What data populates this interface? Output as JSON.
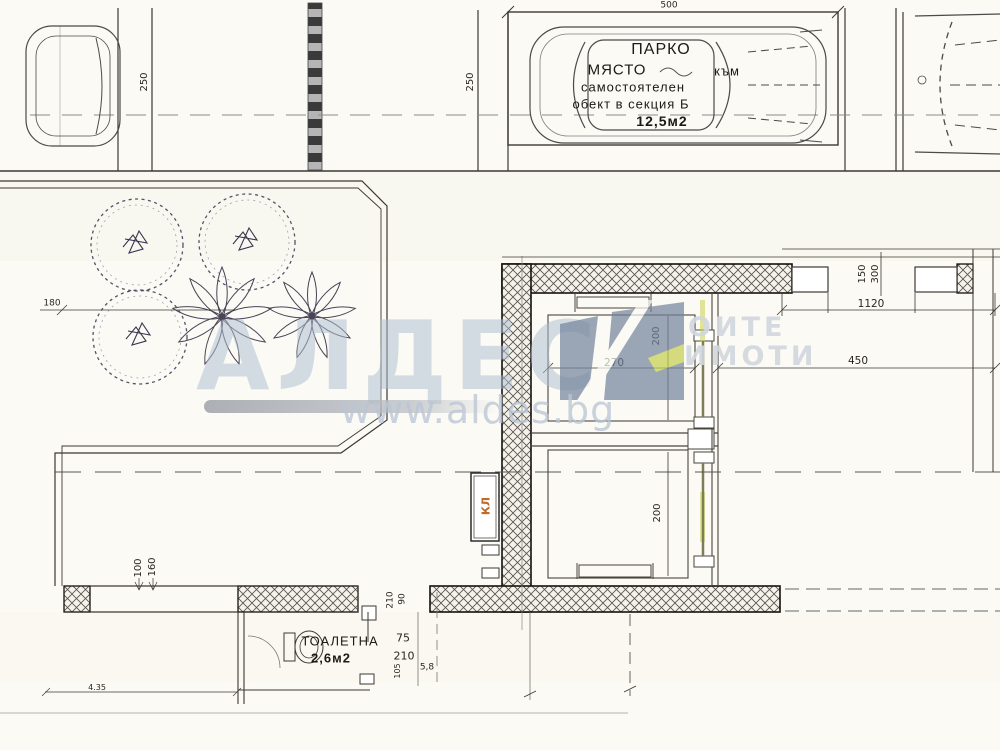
{
  "drawing": {
    "parking_label": {
      "l1": "ПАРКО",
      "l2": "МЯСТО",
      "l2b": "към",
      "l3": "самостоятелен",
      "l4": "обект в секция Б",
      "l5": "12,5м2"
    },
    "toilet_label": {
      "name": "ТОАЛЕТНА",
      "area": "2,6м2"
    },
    "panel_label": "КЛ",
    "dims": {
      "stall_width": "500",
      "stall_depth_left": "250",
      "stall_depth_mid": "250",
      "right_offset": "1120",
      "right_clear": "450",
      "pier_150": "150",
      "pier_300": "300",
      "shaft_width": "270",
      "shaft_height_upper": "200",
      "shaft_height_lower": "200",
      "lobby_210": "210",
      "lobby_90": "90",
      "walk_100": "100",
      "walk_160": "160",
      "toilet_75": "75",
      "toilet_210": "210",
      "toilet_105": "105",
      "toilet_58": "5,8",
      "garden_180": "180",
      "level_435": "4.35"
    }
  },
  "watermark": {
    "brand": "АЛДЕС",
    "tag1": "ОИТЕ",
    "tag2": "ИМОТИ",
    "url": "www.aldes.bg"
  },
  "colors": {
    "line": "#3d3833",
    "accent_orange": "#c06a28",
    "watermark_blue": "#afbdd1",
    "accent_green": "#c9d14f"
  }
}
